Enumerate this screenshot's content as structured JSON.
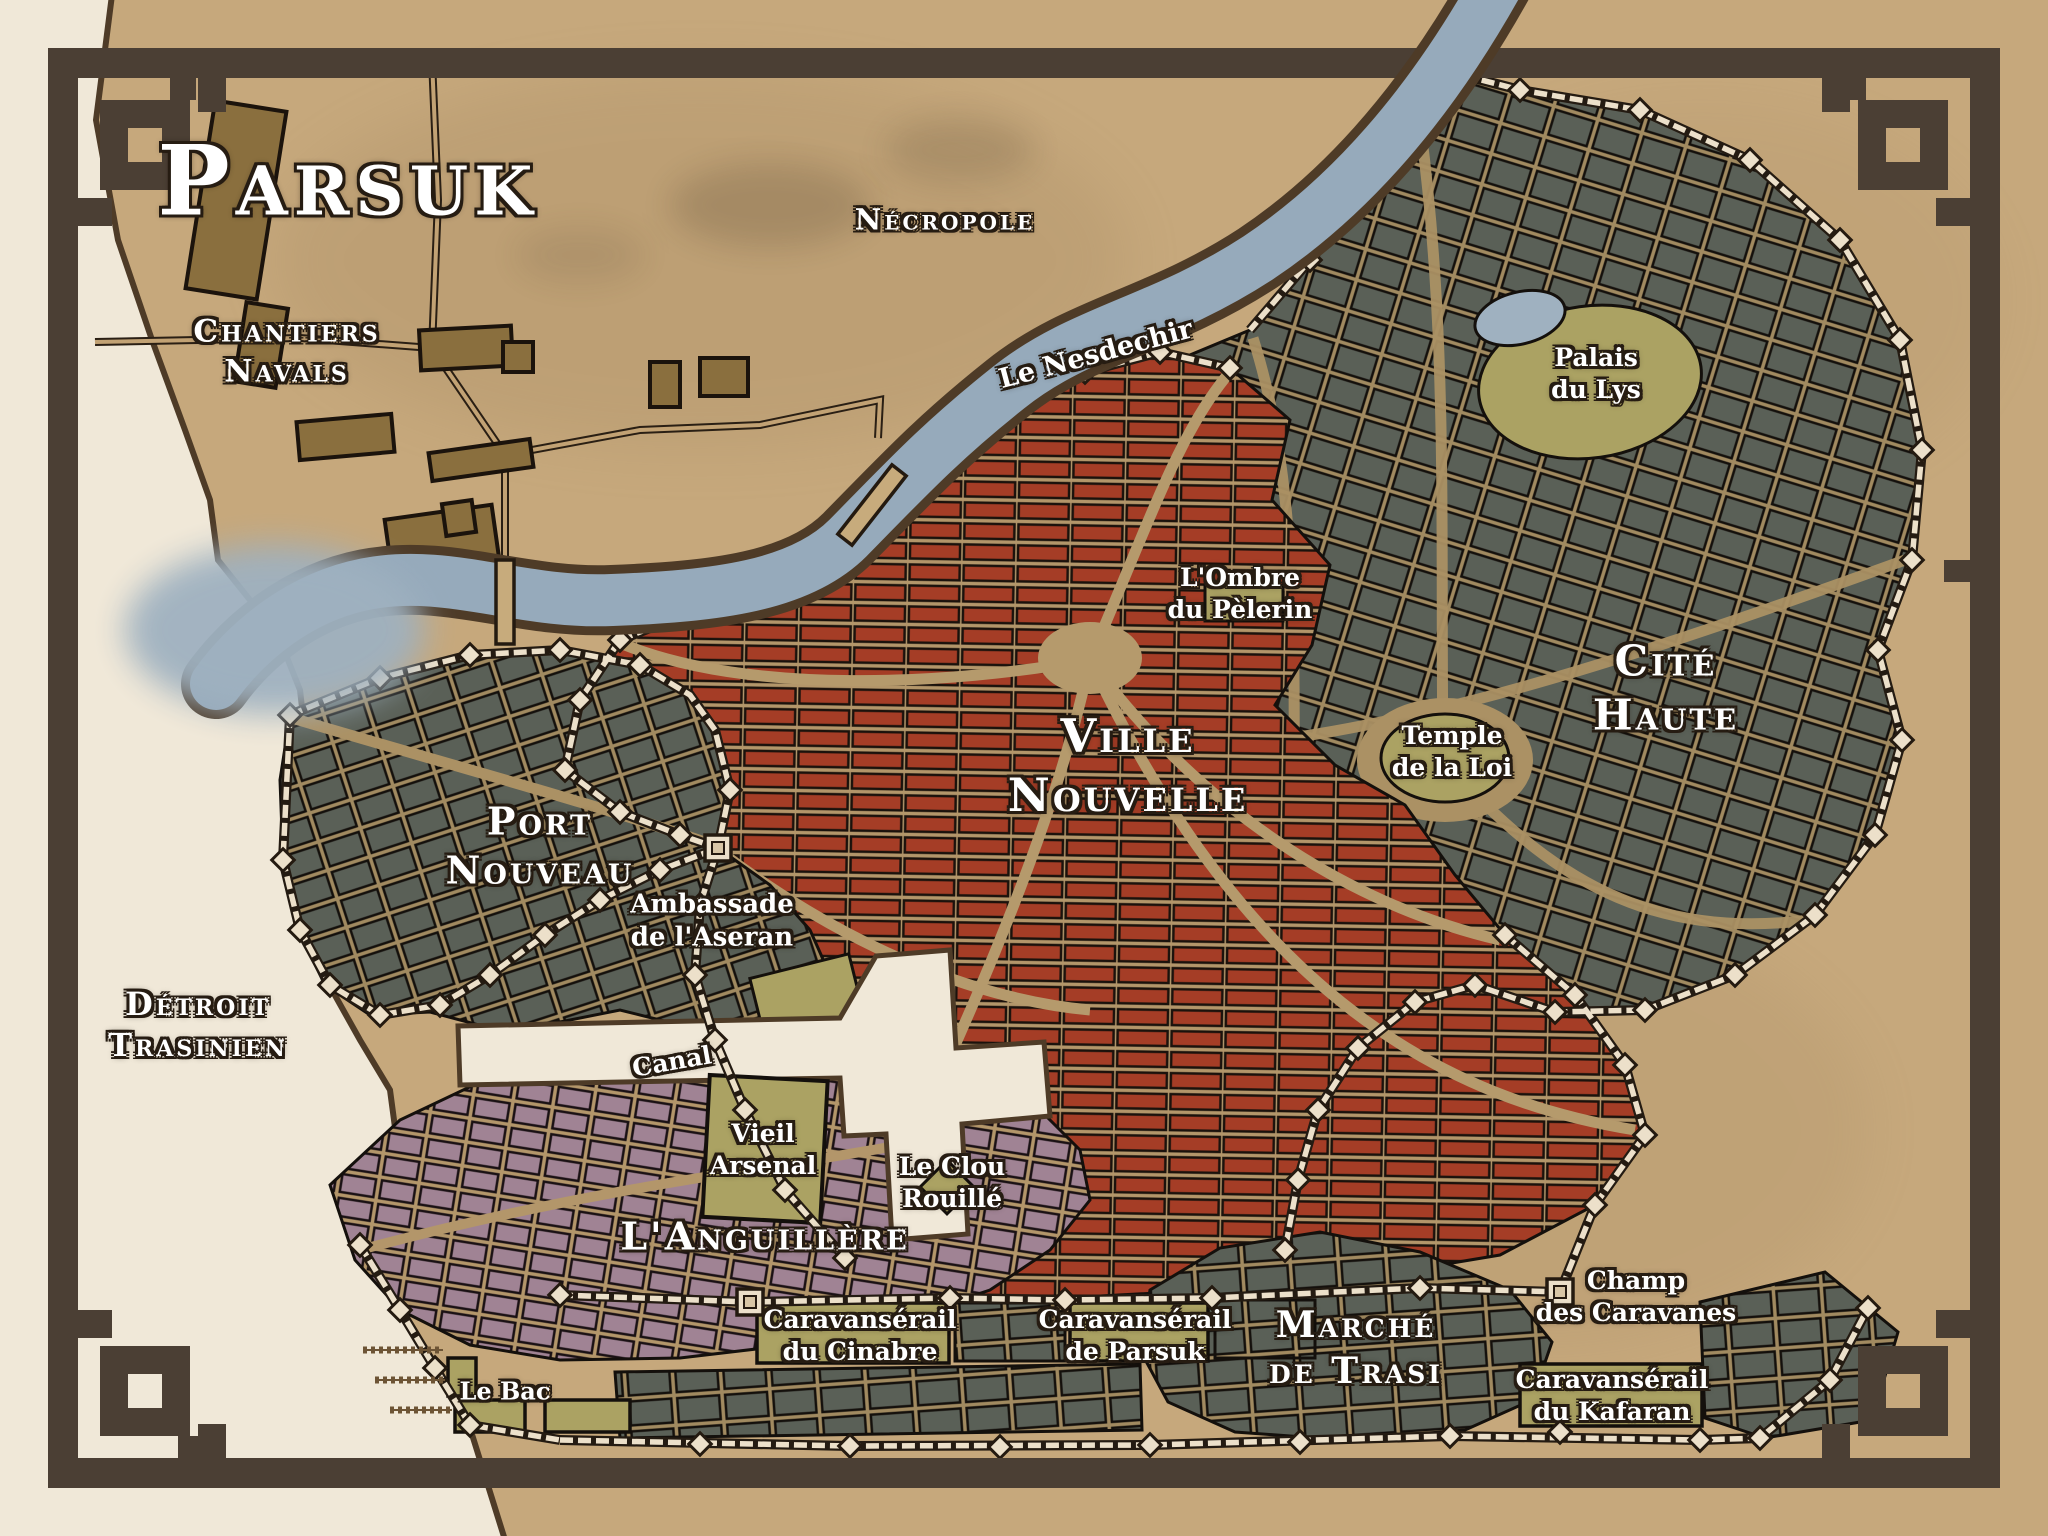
{
  "map": {
    "title": "Parsuk"
  },
  "palette": {
    "paper": "#c6a87c",
    "sea": "#f0e8d8",
    "river": "#96aabb",
    "frame": "#4b3f34",
    "district_red": "#a53d26",
    "district_gray": "#5a6057",
    "district_purple": "#a08394",
    "landmark_olive": "#aba263",
    "wall": "#ece0ca",
    "label_text": "#ffffff"
  },
  "labels": {
    "chantiers": [
      "Chantiers",
      "Navals"
    ],
    "necropole": "Nécropole",
    "river": "Le Nesdechir",
    "palais": [
      "Palais",
      "du Lys"
    ],
    "cite_haute": [
      "Cité",
      "Haute"
    ],
    "ombre": [
      "L'Ombre",
      "du Pèlerin"
    ],
    "ville_nouvelle": [
      "Ville",
      "Nouvelle"
    ],
    "temple": [
      "Temple",
      "de la Loi"
    ],
    "port_nouveau": [
      "Port",
      "Nouveau"
    ],
    "ambassade": [
      "Ambassade",
      "de l'Aseran"
    ],
    "detroit": [
      "Détroit",
      "Trasinien"
    ],
    "canal": "Canal",
    "arsenal": [
      "Vieil",
      "Arsenal"
    ],
    "anguillere": "L'Anguillère",
    "clou": [
      "Le Clou",
      "Rouillé"
    ],
    "cinabre": [
      "Caravansérail",
      "du Cinabre"
    ],
    "caravanserail_parsuk": [
      "Caravansérail",
      "de Parsuk"
    ],
    "marche": [
      "Marché",
      "de Trasi"
    ],
    "champ": [
      "Champ",
      "des Caravanes"
    ],
    "kafaran": [
      "Caravansérail",
      "du Kafaran"
    ],
    "bac": "Le Bac"
  }
}
